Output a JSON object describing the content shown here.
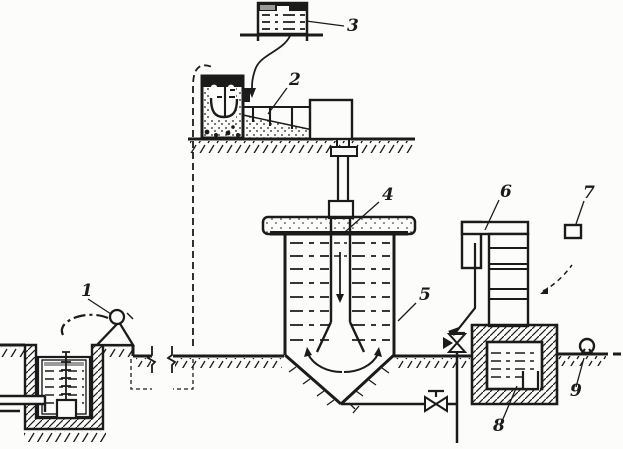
{
  "figure": {
    "kind": "technical-schematic",
    "description_visible_text_only": true
  },
  "labels": [
    "1",
    "2",
    "3",
    "4",
    "5",
    "6",
    "7",
    "8",
    "9"
  ],
  "icons": {
    "valve_vertical": "gate-valve-icon",
    "valve_horizontal": "gate-valve-icon",
    "gauge_circle": "pipeline-device-icon",
    "float_lever": "float-lever-icon"
  },
  "colors": {
    "ink": "#1b1b1b",
    "paper": "#fcfcfa",
    "surface-gray": "#9a9a9a"
  }
}
